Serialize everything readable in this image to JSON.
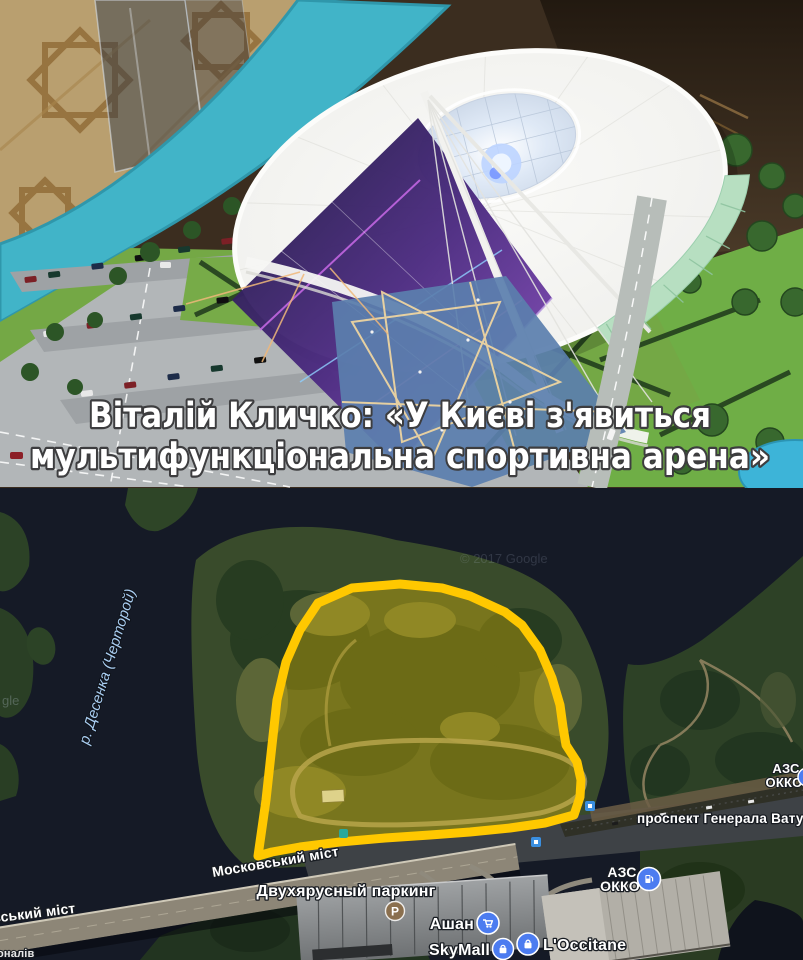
{
  "photo": {
    "caption_line1": "Віталій Кличко: «У Києві з'явиться",
    "caption_line2": "мультифункціональна спортивна арена»"
  },
  "map": {
    "copyright": "© 2017 Google",
    "copyright_partial": "gle",
    "river_label": "р. Десенка (Черторой)",
    "bridge_label": "Московський міст",
    "bridge_label_partial": "овський міст",
    "corner_label_partial": "оналів",
    "parking_label": "Двухярусный паркинг",
    "parking_glyph": "P",
    "avenue_label": "проспект Генерала Ватуті",
    "gas_station_1": {
      "line1": "АЗС",
      "line2": "ОККО"
    },
    "gas_station_2": {
      "line1": "АЗС",
      "line2": "ОККО"
    },
    "poi": {
      "ashan": "Ашан",
      "skymall": "SkyMall",
      "loccitane": "L'Occitane"
    },
    "colors": {
      "highlight_outline": "#FFC800",
      "water": "#151A26",
      "poi_blue": "#4C7CF0",
      "parking_brown": "#8A6F4E"
    }
  }
}
